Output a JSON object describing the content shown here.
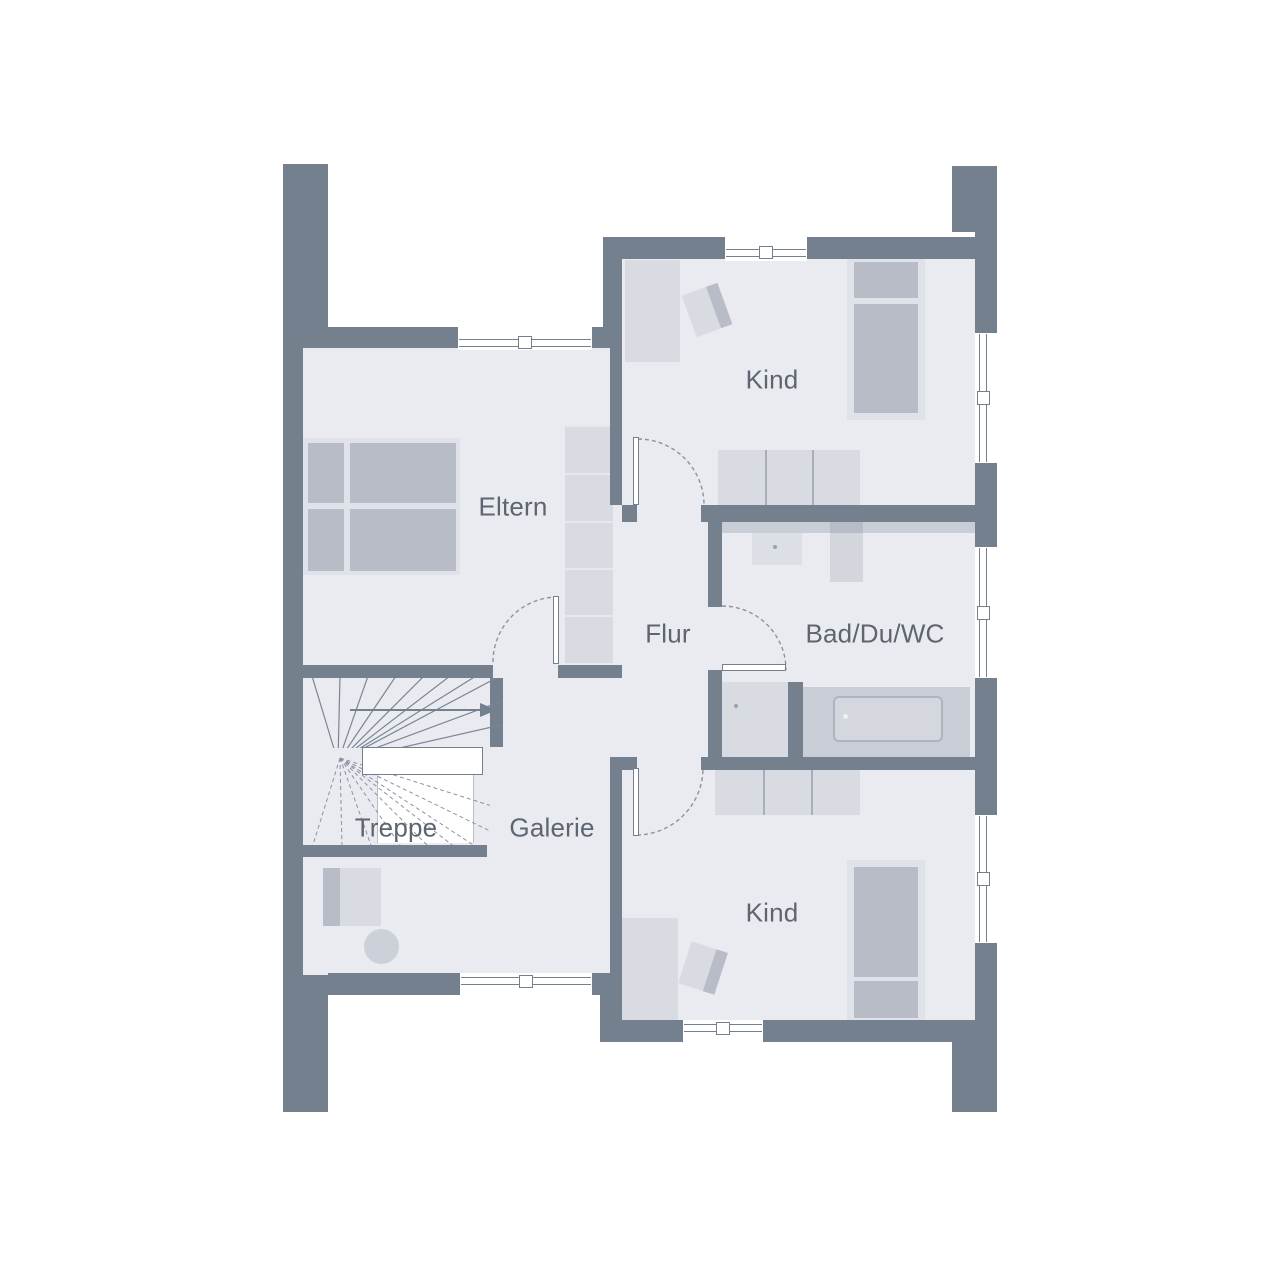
{
  "floorplan": {
    "type": "residential upper-floor plan",
    "rooms": [
      {
        "id": "kind-top",
        "label": "Kind"
      },
      {
        "id": "eltern",
        "label": "Eltern"
      },
      {
        "id": "flur",
        "label": "Flur"
      },
      {
        "id": "bad-du-wc",
        "label": "Bad/Du/WC"
      },
      {
        "id": "treppe",
        "label": "Treppe"
      },
      {
        "id": "galerie",
        "label": "Galerie"
      },
      {
        "id": "kind-bottom",
        "label": "Kind"
      }
    ],
    "colors": {
      "wall": "#75808f",
      "floor": "#e9ebf1",
      "furniture_dark": "#b7bcc7",
      "furniture_light": "#d8dbe2",
      "furniture_frame": "#e0e2e9",
      "counter": "#c9cdd6",
      "label_text": "#5d6571",
      "background": "#ffffff"
    },
    "counts": {
      "windows": 7,
      "doors": 4,
      "rooms_labeled": 7
    }
  }
}
